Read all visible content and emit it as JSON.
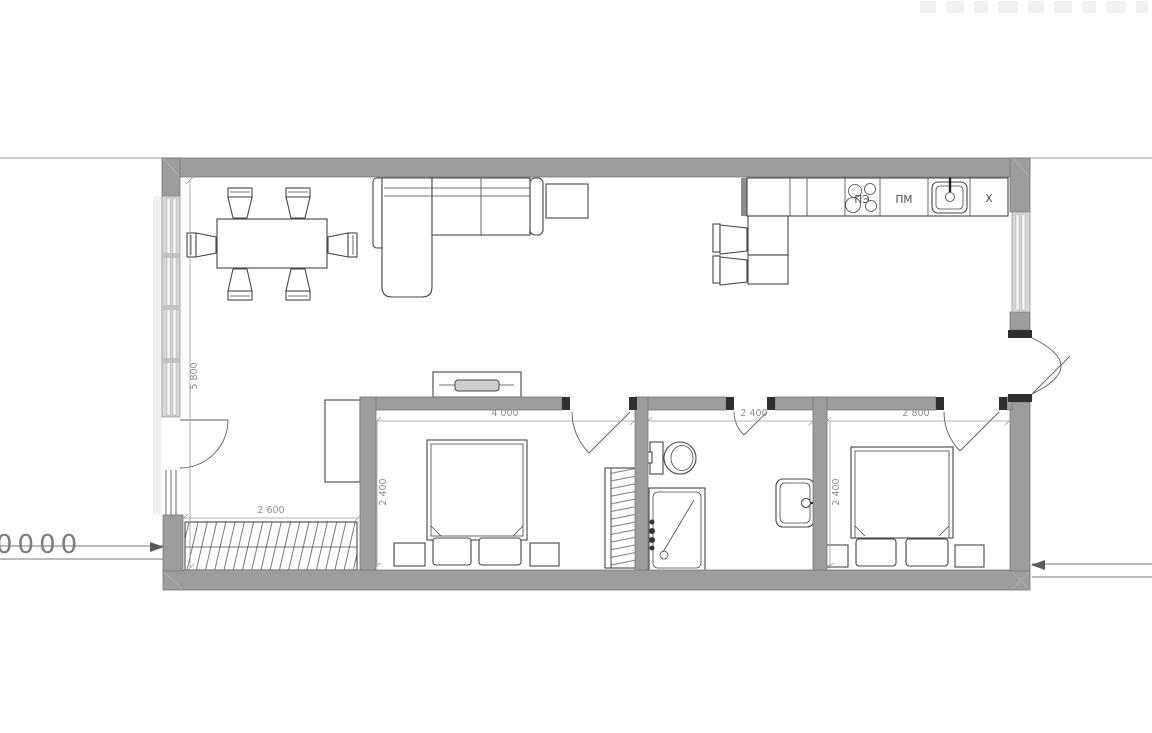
{
  "meta": {
    "type": "apartment-floor-plan",
    "language": "ru"
  },
  "labels": {
    "stove": "ПЭ",
    "dishwasher": "ПМ",
    "fridge": "Х",
    "level_mark": "0000"
  },
  "dimensions": {
    "living_room_depth": "5 800",
    "entry_wardrobe_width": "2 600",
    "bedroom1_width": "4 000",
    "bedroom1_depth": "2 400",
    "bathroom_width": "2 400",
    "bedroom2_width": "2 800",
    "bedroom2_depth": "2 400"
  },
  "colors": {
    "wall": "#9d9d9d",
    "wall_stroke": "#767676",
    "line": "#454545",
    "dim": "#9a9a9a",
    "dim_text": "#8c8c8c",
    "glass": "#d7d7d7"
  }
}
